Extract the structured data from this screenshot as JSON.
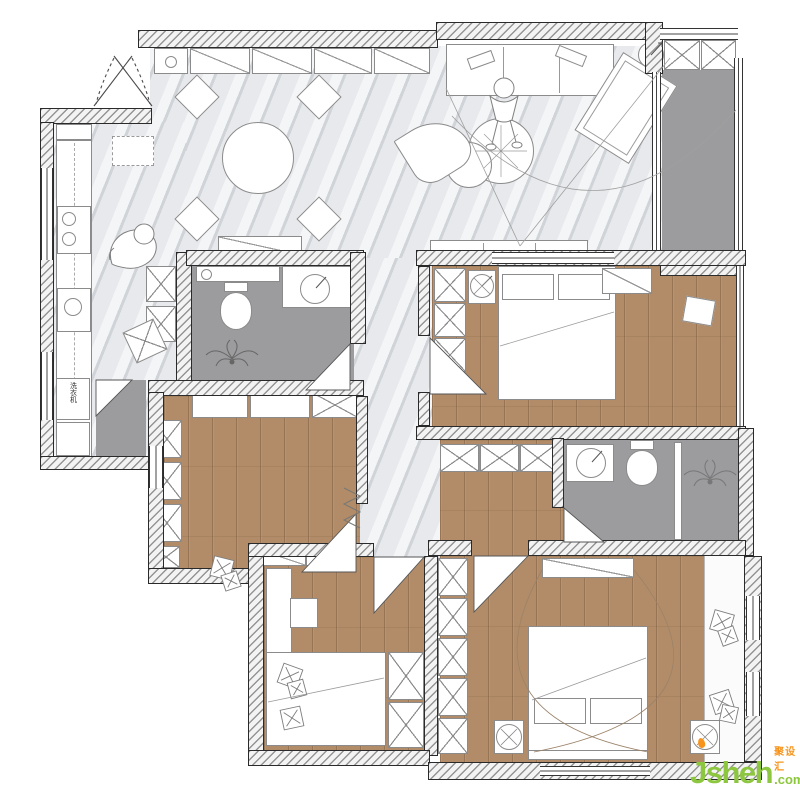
{
  "watermark": {
    "brand": "Jsheh",
    "tld": ".com",
    "cjk": "聚设汇"
  },
  "labels": {
    "washing_machine": "洗衣机"
  },
  "palette": {
    "marble": "#e7e9ec",
    "wood": "#b28c68",
    "tile": "#9c9c9f",
    "green": "#8dc63f",
    "orange": "#f7941d",
    "wall_line": "#2a2a2a",
    "furn_line": "#8b8b8b"
  }
}
